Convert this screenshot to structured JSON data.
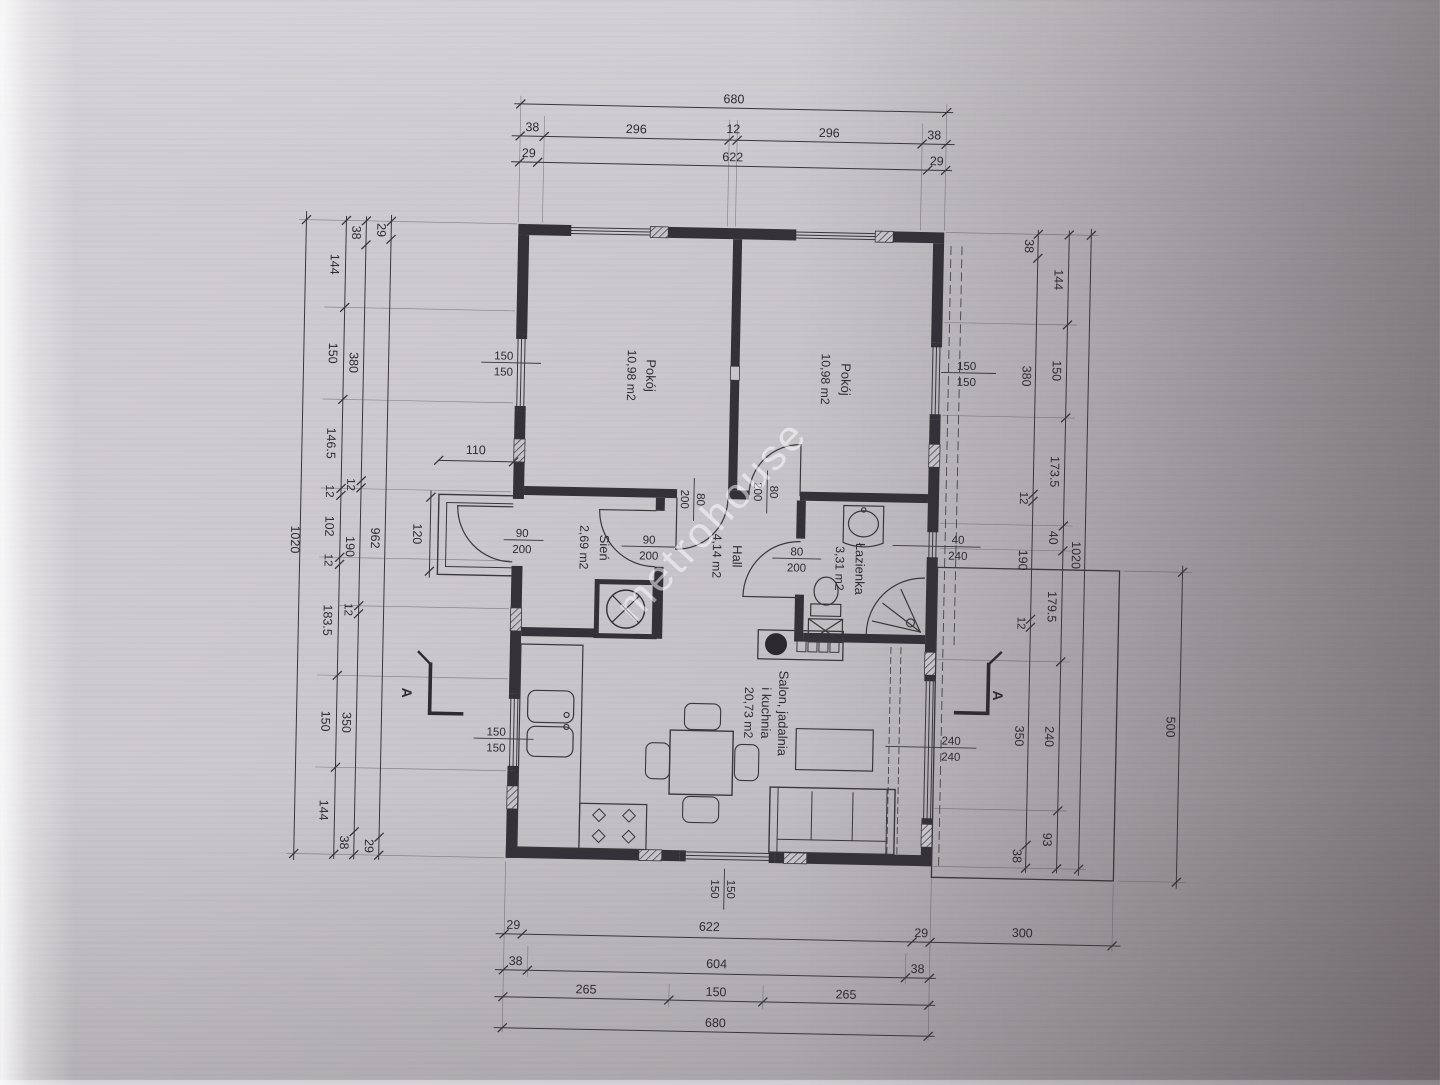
{
  "watermark": {
    "text": "metrohouse"
  },
  "rooms": {
    "pokoj_left": {
      "name": "Pokój",
      "area": "10,98 m2"
    },
    "pokoj_right": {
      "name": "Pokój",
      "area": "10,98 m2"
    },
    "sien": {
      "name": "Sień",
      "area": "2,69 m2"
    },
    "hall": {
      "name": "Hall",
      "area": "4,14 m2"
    },
    "lazienka": {
      "name": "Łazienka",
      "area": "3,31 m2"
    },
    "salon": {
      "line1": "Salon, jadalnia",
      "line2": "i kuchnia",
      "area": "20,73 m2"
    }
  },
  "labels": {
    "wlt": {
      "n": "150",
      "d": "150"
    },
    "wlb": {
      "n": "150",
      "d": "150"
    },
    "wrt": {
      "n": "150",
      "d": "150"
    },
    "bw": {
      "n": "40",
      "d": "240"
    },
    "td": {
      "n": "240",
      "d": "240"
    },
    "bot": {
      "n": "150",
      "d": "150"
    },
    "ent": {
      "n": "90",
      "d": "200"
    },
    "sh": {
      "n": "90",
      "d": "200"
    },
    "rl": {
      "n": "80",
      "d": "200"
    },
    "rr": {
      "n": "80",
      "d": "200"
    },
    "bd": {
      "n": "80",
      "d": "200"
    },
    "d110": "110"
  },
  "dims": {
    "t1": [
      "680"
    ],
    "t2": [
      "38",
      "296",
      "12",
      "296",
      "38"
    ],
    "t3": [
      "29",
      "622",
      "29"
    ],
    "b1": [
      "29",
      "622",
      "29",
      "300"
    ],
    "b2": [
      "38",
      "604",
      "38"
    ],
    "b3": [
      "265",
      "150",
      "265"
    ],
    "b4": [
      "680"
    ],
    "la": [
      "1020"
    ],
    "lb": [
      "144",
      "150",
      "146.5",
      "12",
      "102",
      "12",
      "183.5",
      "150",
      "144"
    ],
    "lc": [
      "38",
      "380",
      "12",
      "190",
      "12",
      "350",
      "38"
    ],
    "ld": [
      "29",
      "962",
      "29"
    ],
    "le": [
      "120"
    ],
    "r1": [
      "38",
      "380",
      "12",
      "190",
      "12",
      "350",
      "38"
    ],
    "r2": [
      "144",
      "150",
      "173.5",
      "40",
      "179.5",
      "240",
      "93"
    ],
    "r3": [
      "1020"
    ],
    "r4": [
      "500"
    ]
  },
  "section": {
    "label": "A"
  },
  "colors": {
    "line": "#3a373b",
    "wall": "#343138",
    "paper": "#c8c5ca",
    "watermark": "rgba(255,255,255,0.52)"
  }
}
